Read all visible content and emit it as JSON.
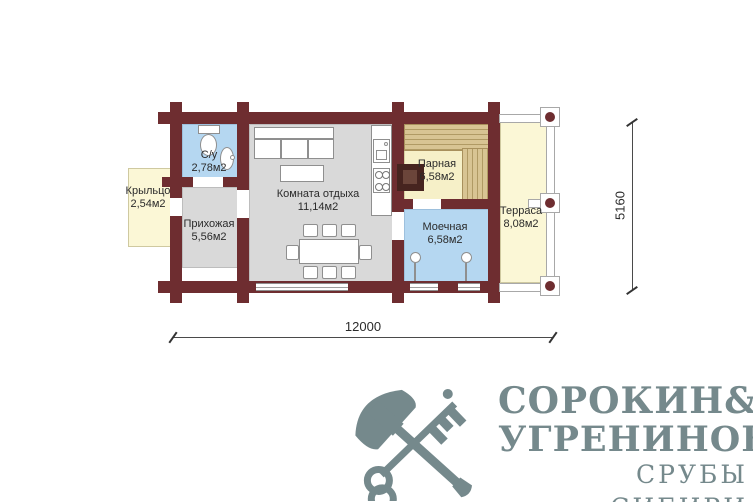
{
  "plan": {
    "rooms": [
      {
        "name": "Крыльцо",
        "area": "2,54м2"
      },
      {
        "name": "С/у",
        "area": "2,78м2"
      },
      {
        "name": "Прихожая",
        "area": "5,56м2"
      },
      {
        "name": "Комната отдыха",
        "area": "11,14м2"
      },
      {
        "name": "Парная",
        "area": "6,58м2"
      },
      {
        "name": "Моечная",
        "area": "6,58м2"
      },
      {
        "name": "Терраса",
        "area": "8,08м2"
      }
    ],
    "dimensions": {
      "width": "12000",
      "height": "5160"
    },
    "colors": {
      "wall": "#6e2d30",
      "wet_room": "#b5d7f1",
      "dry_room": "#d9d9d9",
      "outdoor": "#fbf7d6",
      "steam_room": "#f6f0c8",
      "bench_wood": "#d8c493",
      "stove": "#46241f"
    }
  },
  "logo": {
    "color": "#75898c",
    "name_word1": "СОРОКИН",
    "ampersand": "&",
    "name_word2": "УГРЕНИНОВ",
    "tagline": "СРУБЫ СИБИРИ"
  }
}
